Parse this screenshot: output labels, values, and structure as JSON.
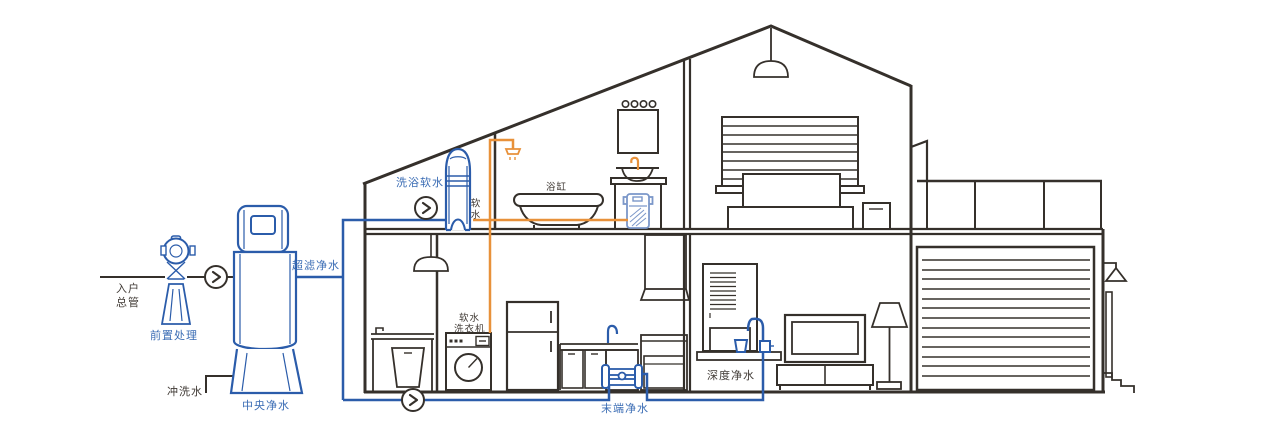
{
  "colors": {
    "background": "#ffffff",
    "outline": "#35302b",
    "pipe-blue": "#2b5caa",
    "pipe-orange": "#e8913a",
    "device-light-blue": "#7b97c9",
    "text-blue": "#3a6cb4",
    "text-dark": "#403a35"
  },
  "labels": {
    "inlet_main_1": "入户",
    "inlet_main_2": "总管",
    "pre_treatment": "前置处理",
    "central_purification": "中央净水",
    "flush_water": "冲洗水",
    "ultrafiltration": "超滤净水",
    "bath_softening": "洗浴软水",
    "soft_water": "软水",
    "bathtub": "浴缸",
    "soft_water_washer_1": "软水",
    "soft_water_washer_2": "洗衣机",
    "terminal_purification": "末端净水",
    "deep_purification": "深度净水"
  },
  "icons": {
    "flow_arrow": "chevron-right-in-circle"
  }
}
